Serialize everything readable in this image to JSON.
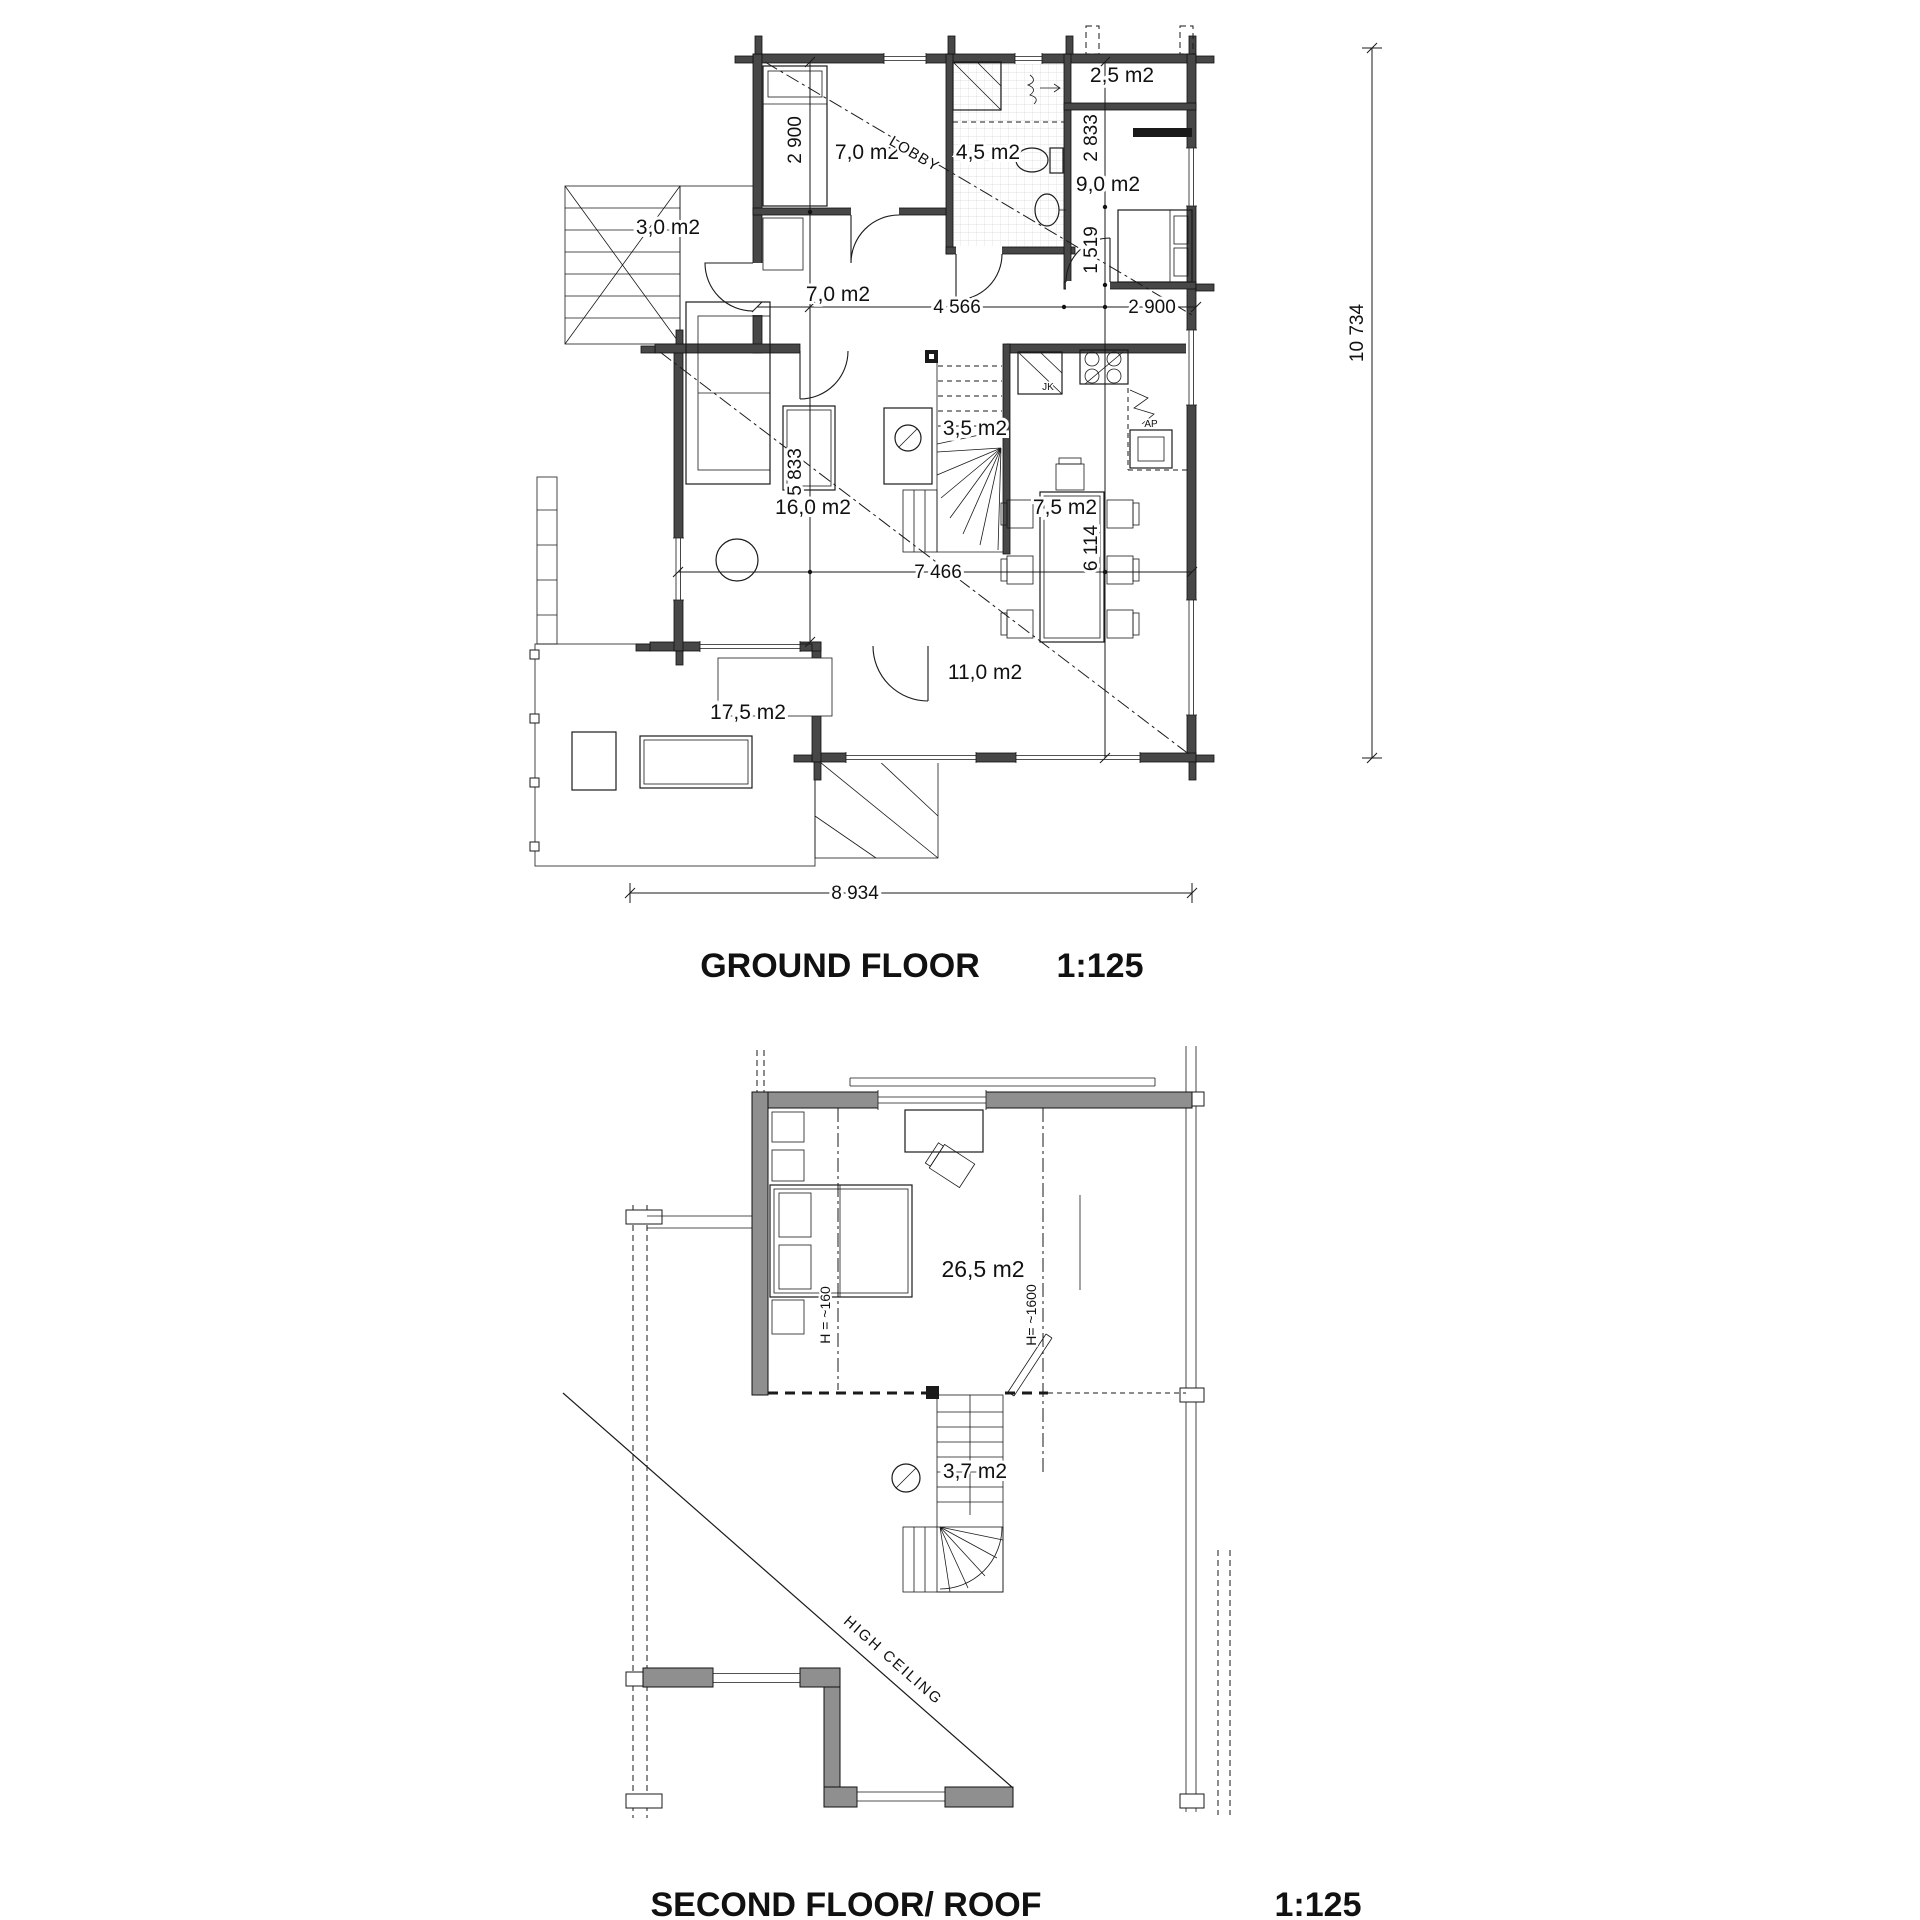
{
  "colors": {
    "paper": "#ffffff",
    "ink": "#1a1a1a",
    "wall_dark": "#474747",
    "wall_gray": "#8f8f8f"
  },
  "ground_floor": {
    "title": "GROUND FLOOR",
    "scale": "1:125",
    "room_label": "LOBBY",
    "areas": {
      "bedroom1": "7,0 m2",
      "bathroom": "4,5 m2",
      "closet": "2,5 m2",
      "bedroom2": "9,0 m2",
      "porch": "3,0 m2",
      "hall": "7,0 m2",
      "stairs": "3,5 m2",
      "living": "16,0 m2",
      "kitchen": "7,5 m2",
      "dining": "11,0 m2",
      "terrace": "17,5 m2"
    },
    "appliances": {
      "fridge": "JK",
      "dishwasher": "AP"
    },
    "dimensions": {
      "bedroom1_height": "2 900",
      "hall_width": "4 566",
      "bedroom2_height": "2 833",
      "lobby_height": "1 519",
      "bedroom2_width": "2 900",
      "living_height": "5 833",
      "kitchen_height": "6 114",
      "living_width": "7 466",
      "total_width": "8 934",
      "total_height": "10 734"
    }
  },
  "second_floor": {
    "title": "SECOND FLOOR/ ROOF",
    "scale": "1:125",
    "areas": {
      "bedroom": "26,5 m2",
      "stairs": "3,7 m2"
    },
    "height_notes": {
      "left": "H = ~160",
      "right": "H= ~1600"
    },
    "annotation": "HIGH CEILING"
  }
}
